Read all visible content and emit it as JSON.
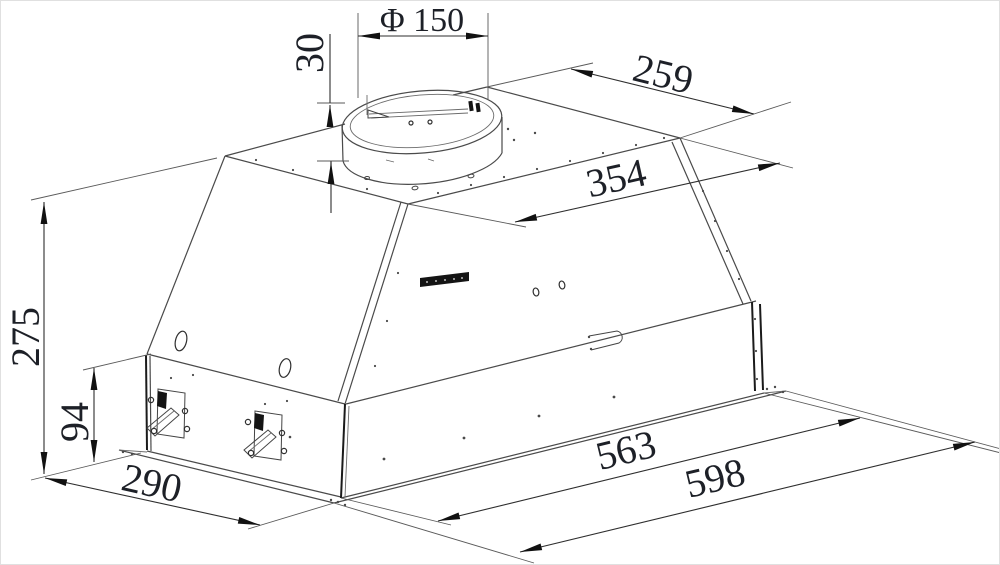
{
  "drawing": {
    "type": "technical-drawing",
    "subject": "built-in cooker hood with round duct collar",
    "background": "#ffffff",
    "line_color": "#4a4a4a",
    "text_color": "#1d2027",
    "dimensions": {
      "duct_diameter": {
        "label": "Φ 150"
      },
      "collar_height": {
        "label": "30"
      },
      "top_rear_edge": {
        "label": "259"
      },
      "top_front_edge": {
        "label": "354"
      },
      "total_height": {
        "label": "275"
      },
      "body_height": {
        "label": "94"
      },
      "base_depth": {
        "label": "290"
      },
      "inner_width": {
        "label": "563"
      },
      "overall_width": {
        "label": "598"
      }
    }
  }
}
